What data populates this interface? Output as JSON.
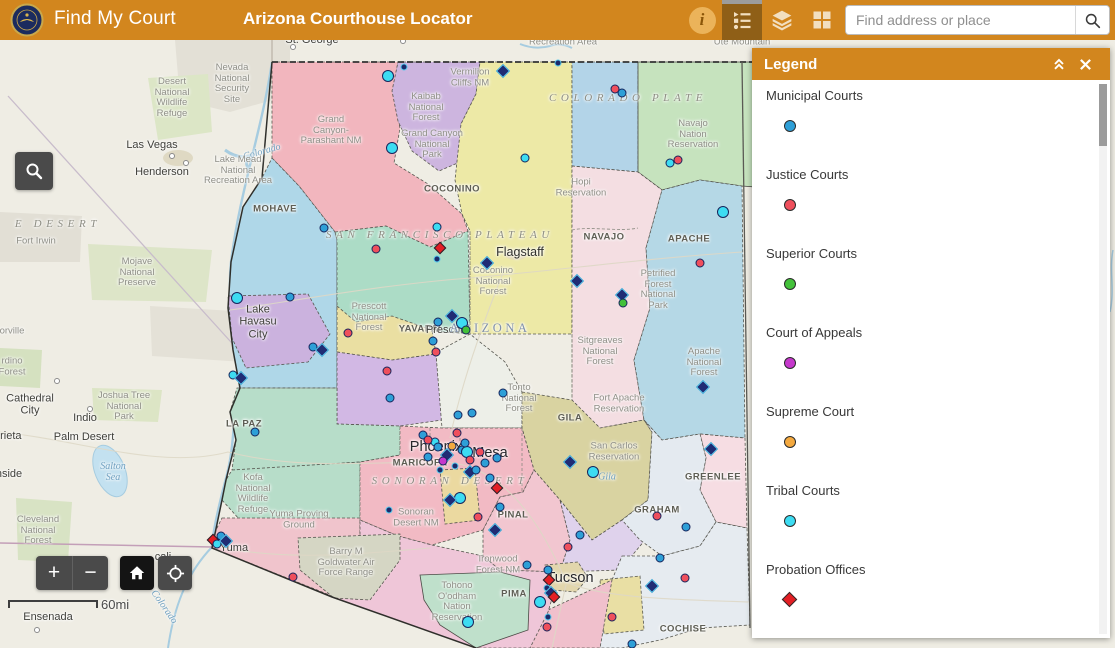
{
  "header": {
    "brand": "Find My Court",
    "title": "Arizona Courthouse Locator",
    "search_placeholder": "Find address or place",
    "icons": [
      "seal-logo",
      "info",
      "legend",
      "layers",
      "basemap-grid",
      "search"
    ]
  },
  "legend": {
    "title": "Legend",
    "items": [
      {
        "label": "Municipal Courts",
        "shape": "circle",
        "color": "#2E9FD7"
      },
      {
        "label": "Justice Courts",
        "shape": "circle",
        "color": "#EF4F5C"
      },
      {
        "label": "Superior Courts",
        "shape": "circle",
        "color": "#43C13A"
      },
      {
        "label": "Court of Appeals",
        "shape": "circle",
        "color": "#C538CC"
      },
      {
        "label": "Supreme Court",
        "shape": "circle",
        "color": "#F4A93F"
      },
      {
        "label": "Tribal Courts",
        "shape": "circle",
        "color": "#3DDCF2"
      },
      {
        "label": "Probation Offices",
        "shape": "diamond",
        "color": "#E31E24"
      }
    ]
  },
  "map": {
    "scale_label": "60mi",
    "controls": {
      "zoom_in": "+",
      "zoom_out": "−"
    },
    "marker_colors": {
      "municipal": "#2E9FD7",
      "justice": "#EF4F5C",
      "superior": "#43C13A",
      "appeals": "#C538CC",
      "supreme": "#F4A93F",
      "tribal": "#3DDCF2",
      "probation": "#E31E24"
    },
    "labels": [
      {
        "t": "St. George",
        "x": 312,
        "y": 40,
        "c": "dk"
      },
      {
        "t": "Recreation Area",
        "x": 563,
        "y": 43
      },
      {
        "t": "Ute Mountain",
        "x": 742,
        "y": 43
      },
      {
        "t": "Nevada\nNational\nSecurity\nSite",
        "x": 232,
        "y": 84
      },
      {
        "t": "Desert\nNational\nWildlife\nRefuge",
        "x": 172,
        "y": 98
      },
      {
        "t": "Las Vegas",
        "x": 152,
        "y": 145,
        "c": "dk"
      },
      {
        "t": "Henderson",
        "x": 162,
        "y": 172,
        "c": "dk"
      },
      {
        "t": "E DESERT",
        "x": 58,
        "y": 224,
        "c": "des"
      },
      {
        "t": "Fort Irwin",
        "x": 36,
        "y": 242
      },
      {
        "t": "Mojave\nNational\nPreserve",
        "x": 137,
        "y": 273
      },
      {
        "t": "orville",
        "x": 12,
        "y": 332
      },
      {
        "t": "rdino\nForest",
        "x": 12,
        "y": 367
      },
      {
        "t": "Cathedral\nCity",
        "x": 30,
        "y": 405,
        "c": "dk"
      },
      {
        "t": "Joshua Tree\nNational\nPark",
        "x": 124,
        "y": 407
      },
      {
        "t": "Indio",
        "x": 85,
        "y": 418,
        "c": "dk"
      },
      {
        "t": "rrieta",
        "x": 9,
        "y": 436,
        "c": "dk"
      },
      {
        "t": "Palm Desert",
        "x": 84,
        "y": 437,
        "c": "dk"
      },
      {
        "t": "nside",
        "x": 9,
        "y": 474,
        "c": "dk"
      },
      {
        "t": "Salton\nSea",
        "x": 113,
        "y": 472,
        "c": "riv"
      },
      {
        "t": "Cleveland\nNational\nForest",
        "x": 38,
        "y": 531
      },
      {
        "t": "Ensenada",
        "x": 48,
        "y": 617,
        "c": "dk"
      },
      {
        "t": "cali",
        "x": 163,
        "y": 557,
        "c": "dk"
      },
      {
        "t": "Colorado",
        "x": 164,
        "y": 607,
        "c": "riv",
        "r": 55
      },
      {
        "t": "Colorado",
        "x": 262,
        "y": 152,
        "c": "riv",
        "r": -16
      },
      {
        "t": "Grand\nCanyon-\nParashant NM",
        "x": 331,
        "y": 131
      },
      {
        "t": "Kaibab\nNational\nForest",
        "x": 426,
        "y": 108
      },
      {
        "t": "Grand Canyon\nNational\nPark",
        "x": 432,
        "y": 145
      },
      {
        "t": "Vermilion\nCliffs NM",
        "x": 470,
        "y": 78
      },
      {
        "t": "COLORADO PLATE",
        "x": 628,
        "y": 98,
        "c": "des"
      },
      {
        "t": "Navajo\nNation\nReservation",
        "x": 693,
        "y": 135
      },
      {
        "t": "Hopi\nReservation",
        "x": 581,
        "y": 188
      },
      {
        "t": "Lake Mead\nNational\nRecreation Area",
        "x": 238,
        "y": 171
      },
      {
        "t": "MOHAVE",
        "x": 275,
        "y": 210,
        "c": "co"
      },
      {
        "t": "COCONINO",
        "x": 452,
        "y": 190,
        "c": "co"
      },
      {
        "t": "SAN FRANCISCO PLATEAU",
        "x": 440,
        "y": 235,
        "c": "des"
      },
      {
        "t": "Flagstaff",
        "x": 520,
        "y": 252,
        "c": "dk2"
      },
      {
        "t": "Coconino\nNational\nForest",
        "x": 493,
        "y": 282
      },
      {
        "t": "NAVAJO",
        "x": 604,
        "y": 238,
        "c": "co"
      },
      {
        "t": "APACHE",
        "x": 689,
        "y": 240,
        "c": "co"
      },
      {
        "t": "Petrified\nForest\nNational\nPark",
        "x": 658,
        "y": 290
      },
      {
        "t": "Prescott\nNational\nForest",
        "x": 369,
        "y": 318
      },
      {
        "t": "YAVAPAI",
        "x": 420,
        "y": 330,
        "c": "co"
      },
      {
        "t": "Prescott",
        "x": 446,
        "y": 330,
        "c": "dk"
      },
      {
        "t": "ARIZONA",
        "x": 490,
        "y": 328,
        "c": "st"
      },
      {
        "t": "Lake\nHavasu\nCity",
        "x": 258,
        "y": 322,
        "c": "dk"
      },
      {
        "t": "LA PAZ",
        "x": 244,
        "y": 425,
        "c": "co"
      },
      {
        "t": "Sitgreaves\nNational\nForest",
        "x": 600,
        "y": 352
      },
      {
        "t": "Fort Apache\nReservation",
        "x": 619,
        "y": 404
      },
      {
        "t": "Apache\nNational\nForest",
        "x": 704,
        "y": 363
      },
      {
        "t": "Tonto\nNational\nForest",
        "x": 519,
        "y": 399
      },
      {
        "t": "GILA",
        "x": 570,
        "y": 419,
        "c": "co"
      },
      {
        "t": "San Carlos\nReservation",
        "x": 614,
        "y": 452
      },
      {
        "t": "Gila",
        "x": 607,
        "y": 477,
        "c": "riv"
      },
      {
        "t": "Phoenix",
        "x": 436,
        "y": 447,
        "c": "big"
      },
      {
        "t": "Mesa",
        "x": 490,
        "y": 453,
        "c": "big"
      },
      {
        "t": "MARICOPA",
        "x": 420,
        "y": 464,
        "c": "co"
      },
      {
        "t": "SONORAN DESERT",
        "x": 450,
        "y": 481,
        "c": "des"
      },
      {
        "t": "Sonoran\nDesert NM",
        "x": 416,
        "y": 518
      },
      {
        "t": "Kofa\nNational\nWildlife\nRefuge",
        "x": 253,
        "y": 494
      },
      {
        "t": "Yuma Proving\nGround",
        "x": 299,
        "y": 520
      },
      {
        "t": "Yuma",
        "x": 234,
        "y": 548,
        "c": "dk"
      },
      {
        "t": "Barry M\nGoldwater Air\nForce Range",
        "x": 346,
        "y": 563
      },
      {
        "t": "PINAL",
        "x": 513,
        "y": 516,
        "c": "co"
      },
      {
        "t": "Ironwood\nForest NM",
        "x": 498,
        "y": 565
      },
      {
        "t": "Tohono\nO'odham\nNation\nReservation",
        "x": 457,
        "y": 602
      },
      {
        "t": "PIMA",
        "x": 514,
        "y": 595,
        "c": "co"
      },
      {
        "t": "Tucson",
        "x": 570,
        "y": 578,
        "c": "big"
      },
      {
        "t": "GREENLEE",
        "x": 713,
        "y": 478,
        "c": "co"
      },
      {
        "t": "GRAHAM",
        "x": 657,
        "y": 511,
        "c": "co"
      },
      {
        "t": "COCHISE",
        "x": 683,
        "y": 630,
        "c": "co"
      }
    ],
    "markers": [
      {
        "t": "nc",
        "x": 404,
        "y": 67
      },
      {
        "t": "nd",
        "x": 503,
        "y": 71
      },
      {
        "t": "nc",
        "x": 558,
        "y": 63
      },
      {
        "t": "t",
        "x": 388,
        "y": 76,
        "b": 1
      },
      {
        "t": "j",
        "x": 615,
        "y": 89
      },
      {
        "t": "m",
        "x": 622,
        "y": 93
      },
      {
        "t": "t",
        "x": 670,
        "y": 163
      },
      {
        "t": "j",
        "x": 678,
        "y": 160
      },
      {
        "t": "t",
        "x": 723,
        "y": 212,
        "b": 1
      },
      {
        "t": "j",
        "x": 700,
        "y": 263
      },
      {
        "t": "t",
        "x": 525,
        "y": 158
      },
      {
        "t": "t",
        "x": 392,
        "y": 148,
        "b": 1
      },
      {
        "t": "m",
        "x": 324,
        "y": 228
      },
      {
        "t": "t",
        "x": 237,
        "y": 298,
        "b": 1
      },
      {
        "t": "t",
        "x": 437,
        "y": 227
      },
      {
        "t": "j",
        "x": 376,
        "y": 249
      },
      {
        "t": "p",
        "x": 440,
        "y": 248
      },
      {
        "t": "nc",
        "x": 437,
        "y": 259
      },
      {
        "t": "nd",
        "x": 487,
        "y": 263
      },
      {
        "t": "nd",
        "x": 577,
        "y": 281
      },
      {
        "t": "nd",
        "x": 622,
        "y": 295
      },
      {
        "t": "s",
        "x": 623,
        "y": 303
      },
      {
        "t": "m",
        "x": 290,
        "y": 297
      },
      {
        "t": "m",
        "x": 313,
        "y": 347
      },
      {
        "t": "nd",
        "x": 322,
        "y": 350
      },
      {
        "t": "t",
        "x": 233,
        "y": 375
      },
      {
        "t": "nd",
        "x": 241,
        "y": 378
      },
      {
        "t": "j",
        "x": 348,
        "y": 333
      },
      {
        "t": "j",
        "x": 387,
        "y": 371
      },
      {
        "t": "m",
        "x": 255,
        "y": 432
      },
      {
        "t": "m",
        "x": 390,
        "y": 398
      },
      {
        "t": "m",
        "x": 438,
        "y": 322
      },
      {
        "t": "nd",
        "x": 452,
        "y": 316
      },
      {
        "t": "t",
        "x": 462,
        "y": 323,
        "b": 1
      },
      {
        "t": "s",
        "x": 466,
        "y": 330
      },
      {
        "t": "m",
        "x": 433,
        "y": 341
      },
      {
        "t": "j",
        "x": 436,
        "y": 352
      },
      {
        "t": "m",
        "x": 472,
        "y": 413
      },
      {
        "t": "m",
        "x": 503,
        "y": 393
      },
      {
        "t": "m",
        "x": 458,
        "y": 415
      },
      {
        "t": "j",
        "x": 457,
        "y": 433
      },
      {
        "t": "m",
        "x": 423,
        "y": 435
      },
      {
        "t": "t",
        "x": 435,
        "y": 442
      },
      {
        "t": "m",
        "x": 438,
        "y": 447
      },
      {
        "t": "nd",
        "x": 447,
        "y": 455
      },
      {
        "t": "m",
        "x": 462,
        "y": 450
      },
      {
        "t": "t",
        "x": 467,
        "y": 452,
        "b": 1
      },
      {
        "t": "j",
        "x": 480,
        "y": 452
      },
      {
        "t": "m",
        "x": 497,
        "y": 458
      },
      {
        "t": "m",
        "x": 428,
        "y": 457
      },
      {
        "t": "a",
        "x": 443,
        "y": 461
      },
      {
        "t": "u",
        "x": 452,
        "y": 446
      },
      {
        "t": "j",
        "x": 470,
        "y": 460
      },
      {
        "t": "nd",
        "x": 470,
        "y": 472
      },
      {
        "t": "m",
        "x": 476,
        "y": 470
      },
      {
        "t": "m",
        "x": 485,
        "y": 463
      },
      {
        "t": "m",
        "x": 465,
        "y": 443
      },
      {
        "t": "nc",
        "x": 455,
        "y": 466
      },
      {
        "t": "m",
        "x": 490,
        "y": 478
      },
      {
        "t": "nc",
        "x": 440,
        "y": 470
      },
      {
        "t": "j",
        "x": 428,
        "y": 440
      },
      {
        "t": "t",
        "x": 460,
        "y": 498,
        "b": 1
      },
      {
        "t": "nd",
        "x": 450,
        "y": 500
      },
      {
        "t": "j",
        "x": 478,
        "y": 517
      },
      {
        "t": "nd",
        "x": 495,
        "y": 530
      },
      {
        "t": "m",
        "x": 500,
        "y": 507
      },
      {
        "t": "p",
        "x": 497,
        "y": 488
      },
      {
        "t": "nc",
        "x": 389,
        "y": 510
      },
      {
        "t": "nd",
        "x": 570,
        "y": 462
      },
      {
        "t": "t",
        "x": 593,
        "y": 472,
        "b": 1
      },
      {
        "t": "m",
        "x": 580,
        "y": 535
      },
      {
        "t": "j",
        "x": 568,
        "y": 547
      },
      {
        "t": "j",
        "x": 293,
        "y": 577
      },
      {
        "t": "p",
        "x": 213,
        "y": 540
      },
      {
        "t": "m",
        "x": 221,
        "y": 536
      },
      {
        "t": "t",
        "x": 217,
        "y": 544
      },
      {
        "t": "nd",
        "x": 226,
        "y": 541
      },
      {
        "t": "m",
        "x": 527,
        "y": 565
      },
      {
        "t": "m",
        "x": 548,
        "y": 570
      },
      {
        "t": "p",
        "x": 549,
        "y": 580
      },
      {
        "t": "nc",
        "x": 547,
        "y": 588
      },
      {
        "t": "nd",
        "x": 551,
        "y": 593
      },
      {
        "t": "p",
        "x": 554,
        "y": 597
      },
      {
        "t": "t",
        "x": 540,
        "y": 602,
        "b": 1
      },
      {
        "t": "nc",
        "x": 548,
        "y": 617
      },
      {
        "t": "j",
        "x": 547,
        "y": 627
      },
      {
        "t": "t",
        "x": 468,
        "y": 622,
        "b": 1
      },
      {
        "t": "m",
        "x": 632,
        "y": 644
      },
      {
        "t": "j",
        "x": 685,
        "y": 578
      },
      {
        "t": "nd",
        "x": 652,
        "y": 586
      },
      {
        "t": "j",
        "x": 612,
        "y": 617
      },
      {
        "t": "m",
        "x": 660,
        "y": 558
      },
      {
        "t": "nd",
        "x": 703,
        "y": 387
      },
      {
        "t": "nd",
        "x": 711,
        "y": 449
      },
      {
        "t": "j",
        "x": 657,
        "y": 516
      },
      {
        "t": "m",
        "x": 686,
        "y": 527
      },
      {
        "t": "w",
        "x": 293,
        "y": 47
      },
      {
        "t": "w",
        "x": 172,
        "y": 156
      },
      {
        "t": "w",
        "x": 186,
        "y": 163
      },
      {
        "t": "w",
        "x": 90,
        "y": 409
      },
      {
        "t": "w",
        "x": 57,
        "y": 381
      },
      {
        "t": "w",
        "x": 37,
        "y": 630
      },
      {
        "t": "w",
        "x": 403,
        "y": 41
      }
    ]
  },
  "colors": {
    "header_bar": "#D2861E",
    "active_tool_bg": "#8F5F17",
    "tool_button_bg": "#4A4A4A",
    "basemap": "#EFEDE4"
  }
}
